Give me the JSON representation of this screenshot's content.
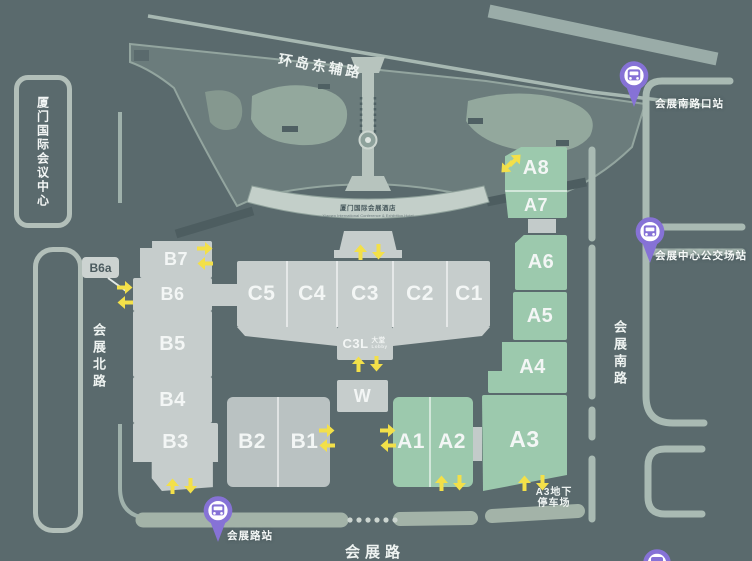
{
  "title": "厦门国际会议中心",
  "roads": {
    "top": "环岛东辅路",
    "west": "会展北路",
    "east": "会展南路",
    "south": "会展路"
  },
  "halls": {
    "b7": "B7",
    "b6": "B6",
    "b6a": "B6a",
    "b5": "B5",
    "b4": "B4",
    "b3": "B3",
    "b2": "B2",
    "b1": "B1",
    "c5": "C5",
    "c4": "C4",
    "c3": "C3",
    "c2": "C2",
    "c1": "C1",
    "w": "W",
    "a1": "A1",
    "a2": "A2",
    "a3": "A3",
    "a4": "A4",
    "a5": "A5",
    "a6": "A6",
    "a7": "A7",
    "a8": "A8"
  },
  "lobby": {
    "label": "C3L",
    "sub_cn": "大堂",
    "sub_en": "Lobby"
  },
  "hotel": {
    "name": "厦门国际会展酒店",
    "name_en": "Xiamen International Conference & Exhibition Hotel"
  },
  "parking": {
    "line1": "A3地下",
    "line2": "停车场"
  },
  "bus_stops": {
    "south_gate": "会展南路口站",
    "terminal": "会展中心公交场站",
    "south": "会展路站"
  },
  "icons": {
    "bus_stop": "bus-pin-icon",
    "entrance": "entrance-arrow-icon"
  },
  "colors": {
    "background": "#5a6a6d",
    "hall_gray": "#c6cdcc",
    "hall_gray_dark": "#bac2c2",
    "hall_green": "#9cc9ad",
    "road": "#a9bab3",
    "garden": "#6b7c7c",
    "garden_light": "#93a89d",
    "accent_yellow": "#f3e049",
    "bus_purple": "#8672d6",
    "text": "#f3f6f5"
  }
}
